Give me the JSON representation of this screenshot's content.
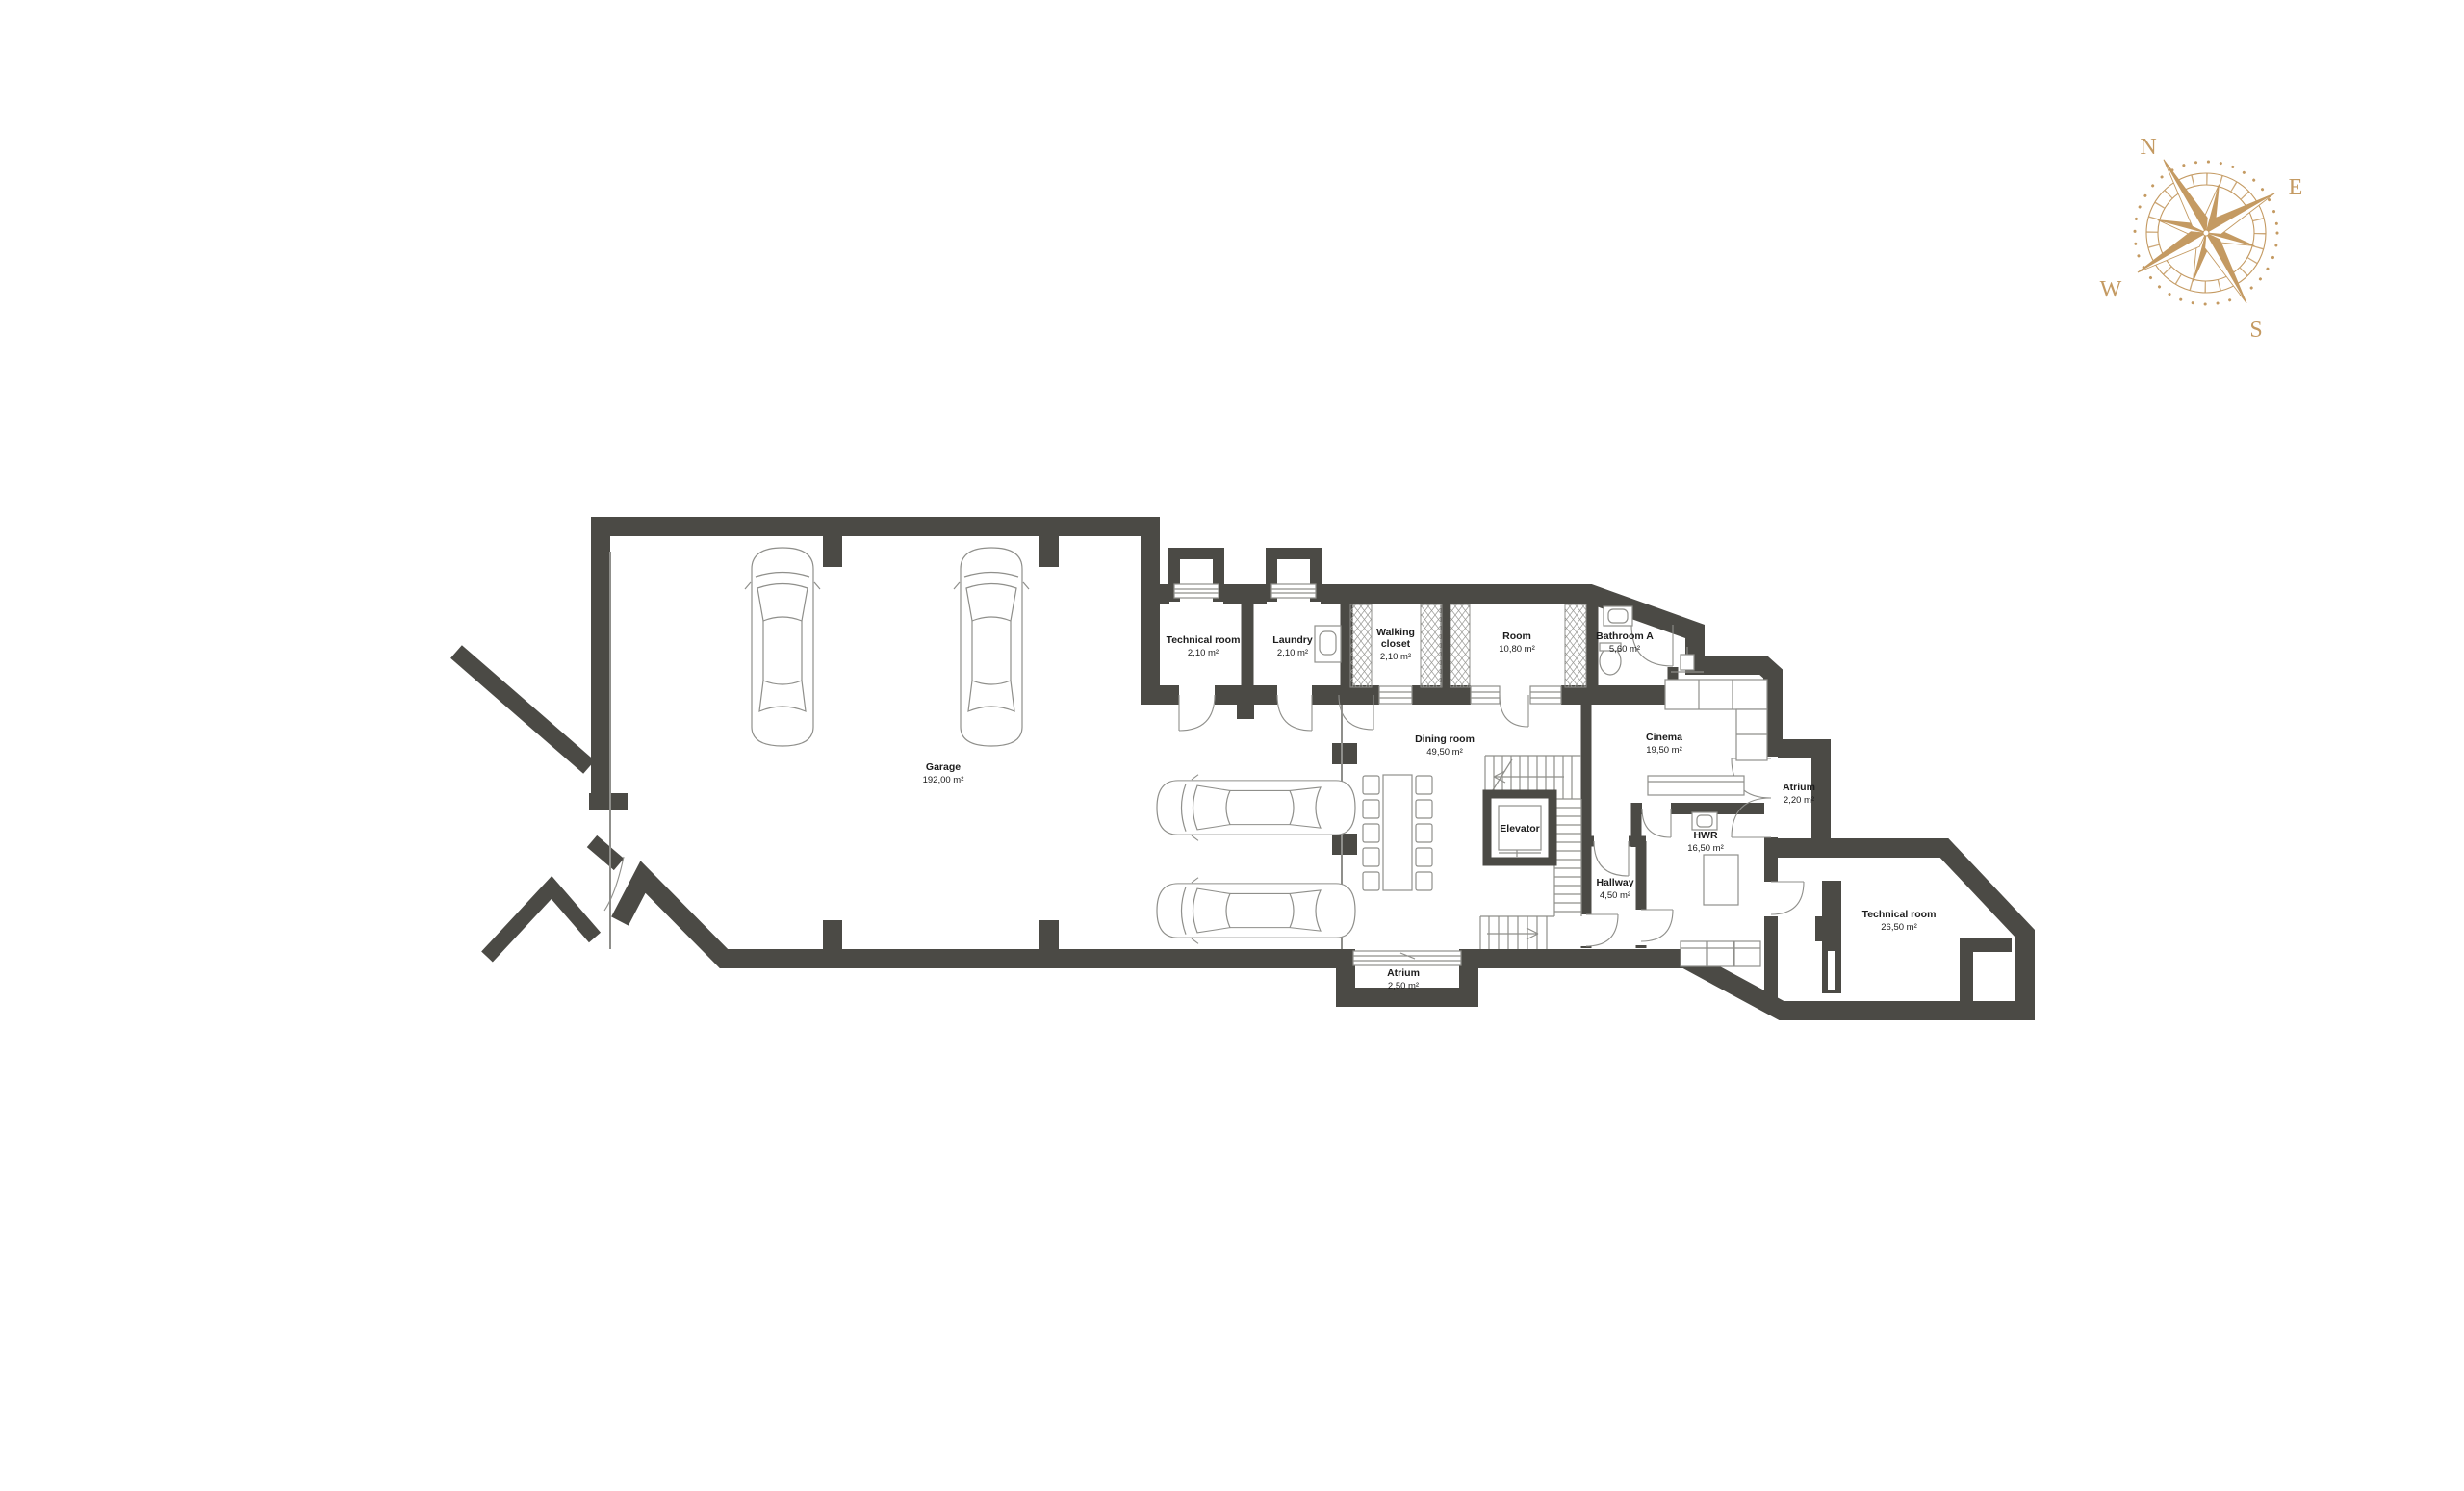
{
  "plan": {
    "rooms": [
      {
        "id": "garage",
        "name": "Garage",
        "area": "192,00 m²"
      },
      {
        "id": "technical-room-small",
        "name": "Technical room",
        "area": "2,10 m²"
      },
      {
        "id": "laundry",
        "name": "Laundry",
        "area": "2,10 m²"
      },
      {
        "id": "walking-closet",
        "name_line1": "Walking",
        "name_line2": "closet",
        "area": "2,10 m²"
      },
      {
        "id": "room",
        "name": "Room",
        "area": "10,80 m²"
      },
      {
        "id": "bathroom-a",
        "name": "Bathroom A",
        "area": "5,60 m²"
      },
      {
        "id": "dining-room",
        "name": "Dining room",
        "area": "49,50 m²"
      },
      {
        "id": "elevator",
        "name": "Elevator"
      },
      {
        "id": "cinema",
        "name": "Cinema",
        "area": "19,50 m²"
      },
      {
        "id": "atrium-upper",
        "name": "Atrium",
        "area": "2,20 m²"
      },
      {
        "id": "hwr",
        "name": "HWR",
        "area": "16,50 m²"
      },
      {
        "id": "hallway",
        "name": "Hallway",
        "area": "4,50 m²"
      },
      {
        "id": "technical-room-large",
        "name": "Technical room",
        "area": "26,50 m²"
      },
      {
        "id": "atrium-lower",
        "name": "Atrium",
        "area": "2,50 m²"
      }
    ]
  },
  "compass": {
    "north": "N",
    "east": "E",
    "south": "S",
    "west": "W"
  },
  "colors": {
    "wall": "#4b4a45",
    "thin_line": "#8f8f8b",
    "compass": "#c49a62",
    "text": "#1c1c1c",
    "background": "#ffffff"
  }
}
